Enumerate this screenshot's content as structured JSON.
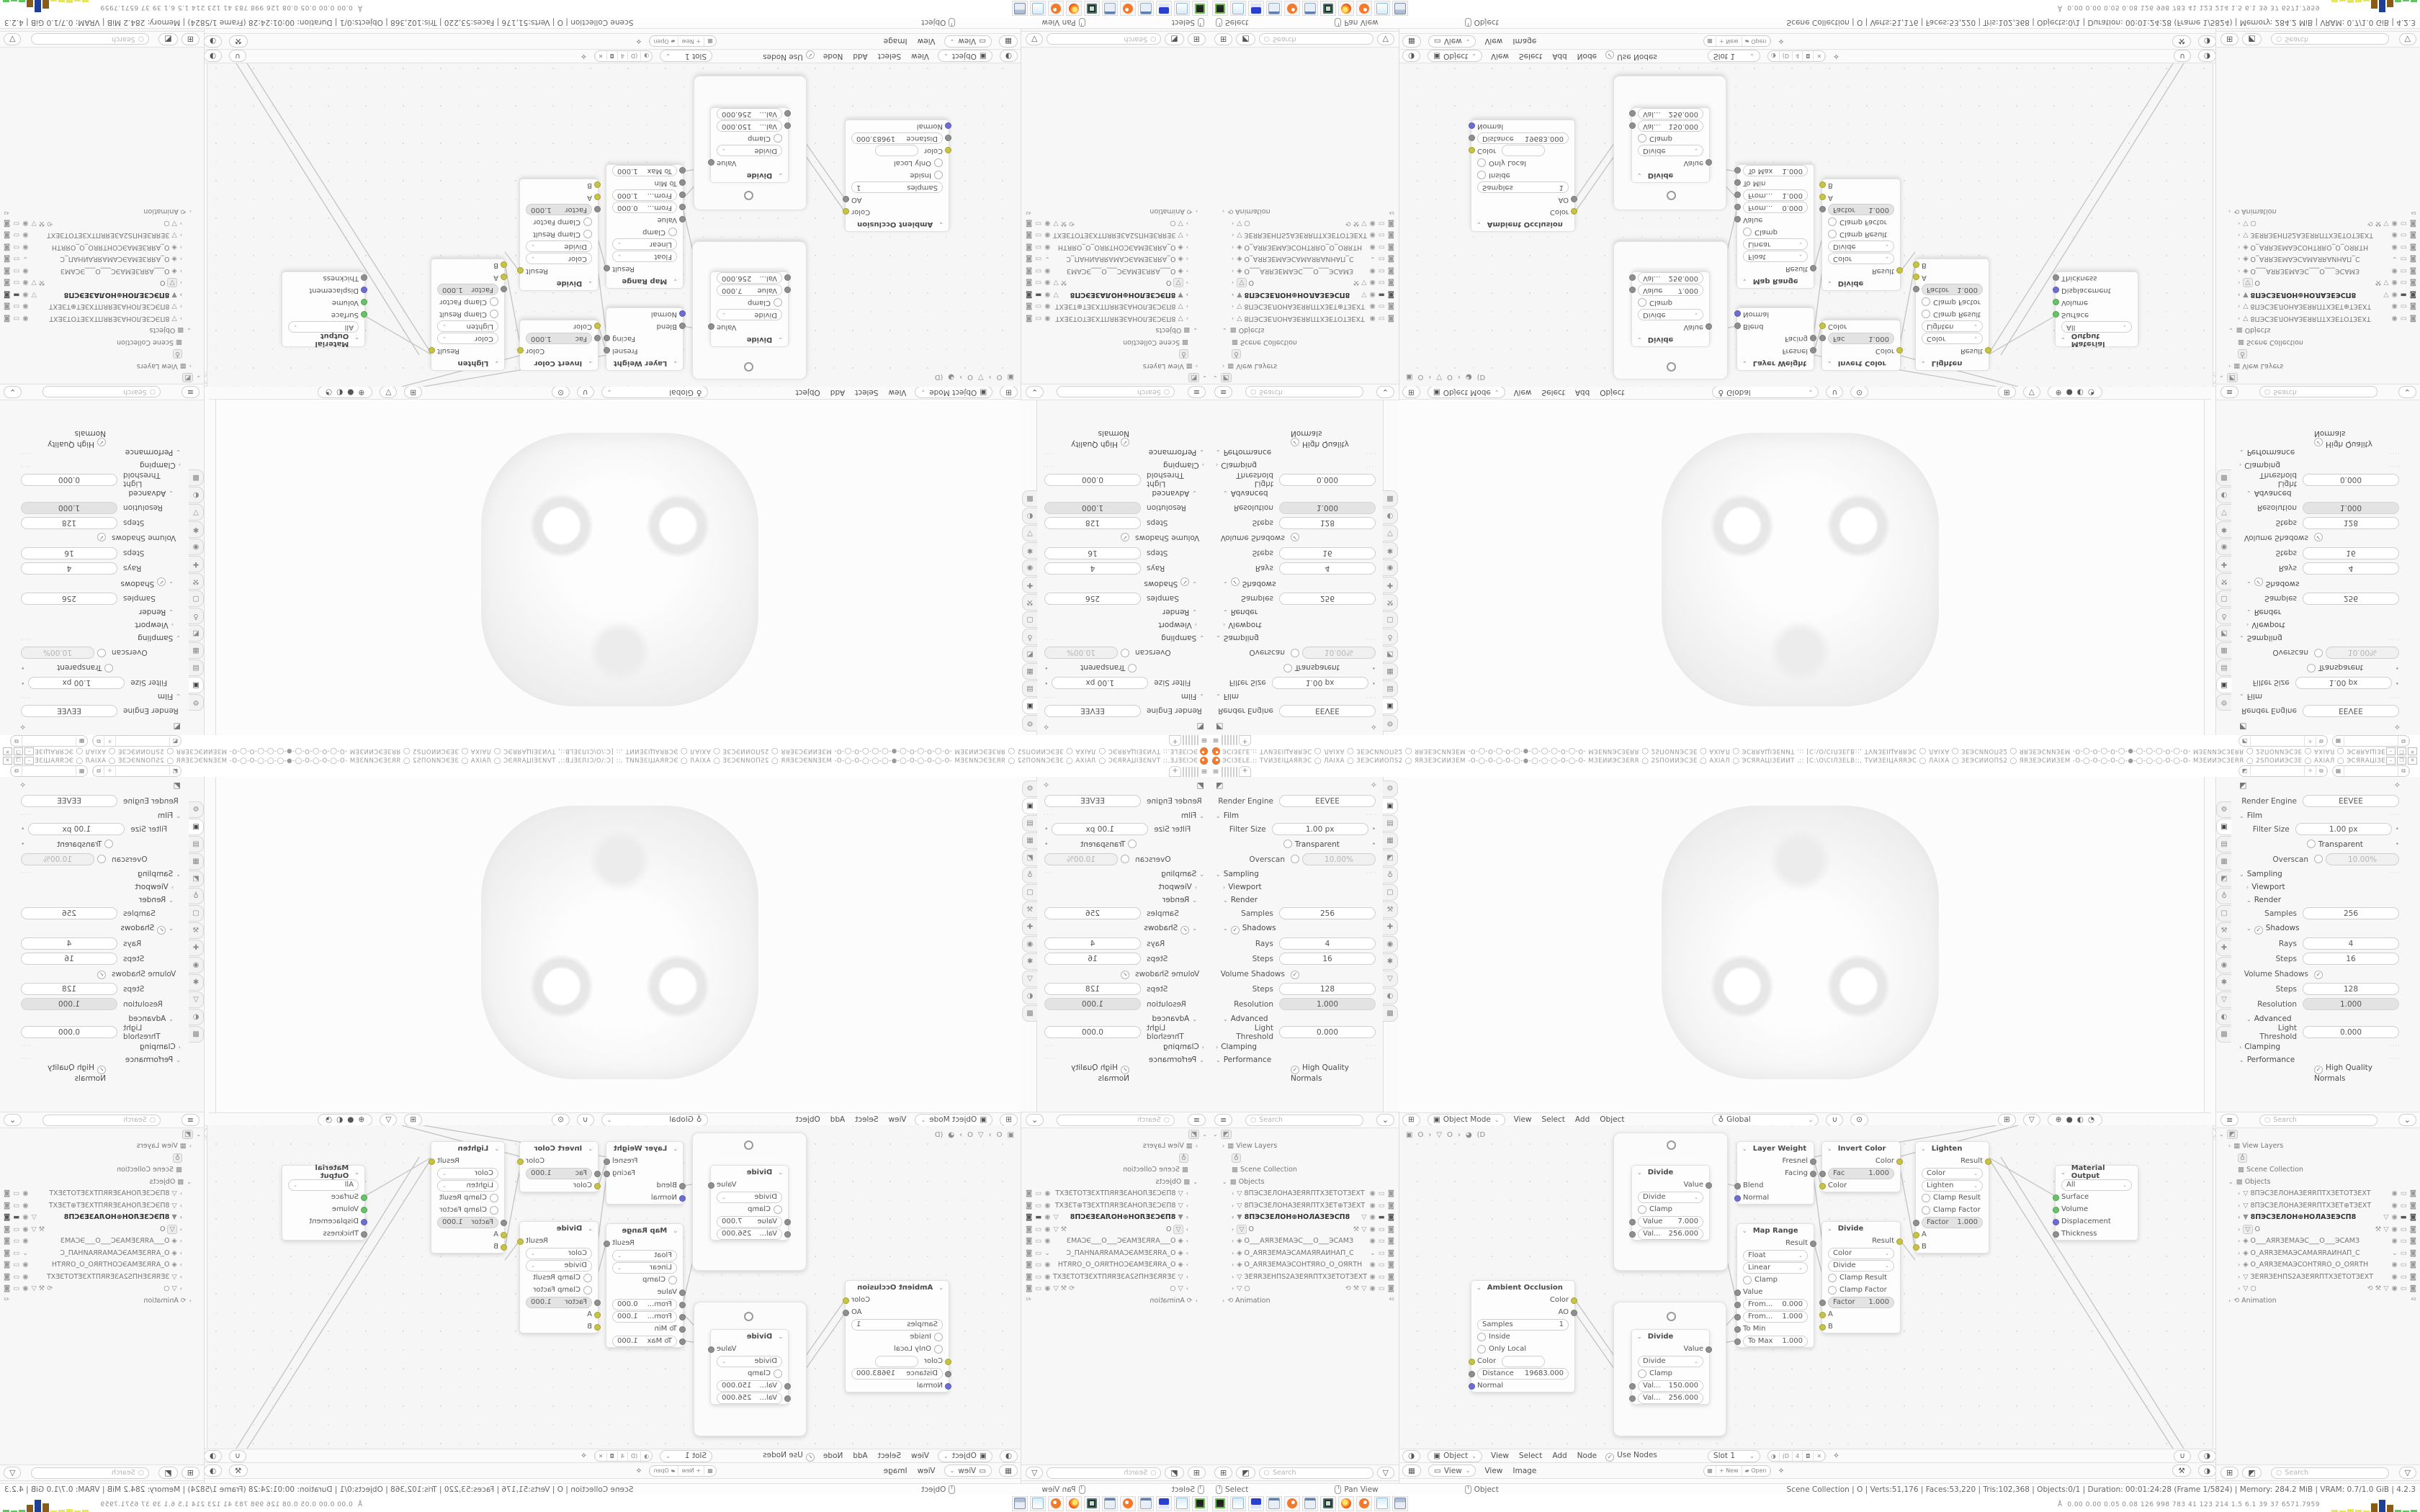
{
  "ui": {
    "search_icon": "○",
    "funnel_icon": "▽",
    "pin_icon": "✧",
    "chev": "⌄",
    "arrow": "›",
    "check": "✓",
    "plus": "+",
    "hamburger": "≡",
    "prop_icon": "◩"
  },
  "title_bar": {
    "title_text": "ЭCIЗЕLЕ.:: ТVИЗЕІЦАЯRЭС ◯ ЛАІХА ◯ ЗЕЭСИИОПЅ2 ◯ ЯRЗЕЭСИИЗЕМ -О-◯-О-◯-О-◯-●-◯-◯-◯-О-◯-О- МЗЕИИЭСЗЕRR ◯ 2ЅПОИИЭСЗЕ ◯ АХІАЛ ◯ ЭСЯRАЦІЗЕИИТ .:: [C:\\О\\СІЛЗЕLВ::, ТVИЗЕІЦАЯRЭС ◯ ЛАІХА ◯ ЗЕЭСИИОПЅ2 ◯ ЯRЗЕЭСИИЗЕМ -О-◯-О-◯-О-◯-●-◯-◯-◯-О-◯-О- МЗЕИИЭСЗЕRR ◯ 2ЅПОИИЭСЗЕ ◯ АХІАЛ ◯ ЭСЯRАЦІЗЕИИТ,:;",
    "minimize": "–",
    "maximize": "❐",
    "close": "✕"
  },
  "tab_row": {
    "tab_widths": [
      14,
      14,
      27,
      26,
      36,
      58
    ],
    "active_index": 2
  },
  "properties": {
    "render_engine_label": "Render Engine",
    "render_engine_value": "EEVEE",
    "film": "Film",
    "filter_size": "Filter Size",
    "filter_size_value": "1.00 px",
    "transparent": "Transparent",
    "overscan": "Overscan",
    "overscan_value": "10.00%",
    "sampling": "Sampling",
    "viewport": "Viewport",
    "render": "Render",
    "samples": "Samples",
    "samples_value": "256",
    "shadows": "Shadows",
    "rays": "Rays",
    "rays_value": "4",
    "steps": "Steps",
    "steps_value": "16",
    "volume_shadows": "Volume Shadows",
    "vs_steps_label": "Steps",
    "vs_steps_value": "128",
    "resolution": "Resolution",
    "resolution_value": "1.000",
    "advanced": "Advanced",
    "light_threshold": "Light Threshold",
    "light_threshold_value": "0.000",
    "clamping": "Clamping",
    "performance": "Performance",
    "hq_normals": "High Quality Normals",
    "tab_icons": [
      "⚙",
      "▣",
      "▤",
      "▦",
      "◩",
      "♁",
      "▢",
      "⚒",
      "✚",
      "◉",
      "✱",
      "▽",
      "◐",
      "▩"
    ],
    "active_tab": 1
  },
  "outliner": {
    "search_placeholder": "Search",
    "rows": [
      {
        "ind": 0,
        "chev": "⌄",
        "icon": "◩",
        "boxed": true,
        "name": "",
        "trail": "none"
      },
      {
        "ind": 1,
        "chev": "›",
        "icon": "▦",
        "name": "View Layers",
        "icon2": "▦",
        "trail": "none"
      },
      {
        "ind": 2,
        "chev": "",
        "icon": "♁",
        "boxed": true,
        "name": "",
        "trail": "none"
      },
      {
        "ind": 2,
        "chev": "",
        "icon": "▩",
        "name": "Scene Collection",
        "trail": "none"
      },
      {
        "ind": 1,
        "chev": "⌄",
        "icon": "▩",
        "name": "Objects",
        "trail": "none"
      },
      {
        "ind": 2,
        "chev": "›",
        "icon": "▽",
        "name": "8ПЭСЗЕЛОНАЗЕЯRПТХЗЕТОТЗЕХТ",
        "trail": "std"
      },
      {
        "ind": 2,
        "chev": "›",
        "icon": "▽",
        "name": "8ПЭСЗЕЛОНАЗЕЯRПТХЗЕТ⊕ТЗЕХТ",
        "trail": "std"
      },
      {
        "ind": 2,
        "chev": "›",
        "icon": "▼",
        "name": "8ПЭСЗЕЛОН⊕НОЛАЗЕЭСП8",
        "sel": true,
        "mid": "▽",
        "trail": "filled"
      },
      {
        "ind": 2,
        "chev": "›",
        "icon": "▽",
        "boxed": true,
        "name": "O",
        "mid": "⚒ ▽",
        "trail": "std"
      },
      {
        "ind": 2,
        "chev": "›",
        "icon": "◈",
        "name": "O___АЯRЗЕМАЭС___O___ЭСАМЗ",
        "trail": "std"
      },
      {
        "ind": 2,
        "chev": "›",
        "icon": "◈",
        "name": "O_АЯRЗЕМАЭСАМАЯRАИНАП_С",
        "trail": "chev"
      },
      {
        "ind": 2,
        "chev": "›",
        "icon": "◈",
        "name": "O_АЯRЗЕМАЭСОНТЯRО_О_ОЯRТН",
        "trail": "std"
      },
      {
        "ind": 2,
        "chev": "›",
        "icon": "▽",
        "name": "ЗЕЯRЗЕНПЅ2АЗЕЯRПТХЗЕТОТЗЕХТ",
        "trail": "std"
      },
      {
        "ind": 2,
        "chev": "›",
        "icon": "▽",
        "name": "○",
        "mid": "⟲ ⚒ ▽",
        "trail": "std"
      },
      {
        "ind": 1,
        "chev": "›",
        "icon": "⟲",
        "name": "Animation",
        "badge": "⁴²",
        "trail": "none"
      }
    ],
    "eye": "◉",
    "screen": "▭",
    "camera": "◙"
  },
  "viewport_header": {
    "editor_icon": "⊞",
    "mode_icon": "▣",
    "mode": "Object Mode",
    "menus": [
      "View",
      "Select",
      "Add",
      "Object"
    ],
    "orientation_icon": "♁",
    "orientation": "Global",
    "snap_icon": "∪",
    "prop_edit_icon": "⊙",
    "shading": [
      "⊕",
      "●",
      "◐",
      "◔"
    ]
  },
  "node_editor": {
    "menus": [
      "View",
      "Select",
      "Add",
      "Node"
    ],
    "breadcrumb": {
      "i1": "▣",
      "t1": "O",
      "sep": "›",
      "i2": "▽",
      "t2": "O",
      "i3": "◕",
      "t3": "(D"
    },
    "header": {
      "slot_icon": "▢",
      "shield": "◘",
      "copy": "⧉",
      "x": "✕"
    },
    "bottom": {
      "editor_icon": "◑",
      "context_icon": "▣",
      "context": "Object",
      "use_nodes": "Use Nodes",
      "slot": "Slot 1",
      "mat_icon": "◑",
      "mat_name": "(D",
      "users": "4",
      "shield": "◘",
      "x": "✕"
    },
    "nodes": {
      "ao": {
        "title": "Ambient Occlusion",
        "out1": "Color",
        "out2": "AO",
        "samples_l": "Samples",
        "samples_v": "1",
        "inside": "Inside",
        "only_local": "Only Local",
        "color_in": "Color",
        "dist_l": "Distance",
        "dist_v": "19683.000",
        "normal": "Normal"
      },
      "div1": {
        "title": "Divide",
        "out": "Value",
        "op": "Divide",
        "clamp": "Clamp",
        "v1l": "Value",
        "v1": "7.000",
        "v2l": "Val...",
        "v2": "256.000"
      },
      "div2": {
        "title": "Divide",
        "out": "Value",
        "op": "Divide",
        "clamp": "Clamp",
        "v1l": "Val...",
        "v1": "150.000",
        "v2l": "Val...",
        "v2": "256.000"
      },
      "lw": {
        "title": "Layer Weight",
        "fresnel": "Fresnel",
        "facing": "Facing",
        "blend": "Blend",
        "normal": "Normal"
      },
      "mr": {
        "title": "Map Range",
        "result": "Result",
        "type": "Float",
        "interp": "Linear",
        "clamp": "Clamp",
        "value": "Value",
        "fm_l": "From...",
        "fm_v": "0.000",
        "fx_l": "From...",
        "fx_v": "1.000",
        "tomin": "To Min",
        "tomax_l": "To Max",
        "tomax_v": "1.000"
      },
      "ic": {
        "title": "Invert Color",
        "out": "Color",
        "fac_l": "Fac",
        "fac_v": "1.000",
        "cin": "Color"
      },
      "dc": {
        "title": "Divide",
        "out": "Result",
        "t1": "Color",
        "t2": "Divide",
        "c1": "Clamp Result",
        "c2": "Clamp Factor",
        "fac_l": "Factor",
        "fac_v": "1.000",
        "a": "A",
        "b": "B"
      },
      "li": {
        "title": "Lighten",
        "out": "Result",
        "t1": "Color",
        "t2": "Lighten",
        "c1": "Clamp Result",
        "c2": "Clamp Factor",
        "fac_l": "Factor",
        "fac_v": "1.000",
        "a": "A",
        "b": "B"
      },
      "mo": {
        "title": "Material Output",
        "target": "All",
        "surface": "Surface",
        "volume": "Volume",
        "displacement": "Displacement",
        "thickness": "Thickness"
      }
    },
    "links": [
      [
        430,
        77,
        469,
        84
      ],
      [
        430,
        77,
        469,
        244
      ],
      [
        243,
        240,
        323,
        354
      ],
      [
        243,
        258,
        323,
        372
      ],
      [
        430,
        305,
        469,
        299
      ],
      [
        430,
        305,
        469,
        262
      ],
      [
        575,
        44,
        587,
        84
      ],
      [
        575,
        64,
        604,
        282
      ],
      [
        693,
        44,
        717,
        170
      ],
      [
        695,
        158,
        717,
        187
      ],
      [
        575,
        158,
        604,
        265
      ],
      [
        818,
        44,
        911,
        98
      ],
      [
        693,
        44,
        860,
        0
      ],
      [
        575,
        44,
        830,
        0
      ],
      [
        818,
        44,
        1075,
        449
      ],
      [
        836,
        44,
        1090,
        449
      ]
    ]
  },
  "image_editor": {
    "editor_icon": "▦",
    "view_icon": "▭",
    "view": "View",
    "menus": [
      "View",
      "Image"
    ],
    "new_label": "New",
    "open_label": "Open",
    "folder_icon": "▰"
  },
  "status_bar": {
    "hints": [
      {
        "label": "Select"
      },
      {
        "label": "Pan View"
      },
      {
        "label": "Object"
      }
    ],
    "stats": "Scene Collection | O | Verts:51,176 | Faces:53,220 | Tris:102,368 | Objects:0/1 | Duration: 00:01:24:28 (Frame 1/5824) | Memory: 284.2 MiB | VRAM: 0.7/1.0 GiB | 4.2.3"
  },
  "taskbar": {
    "icons": [
      "console-app-icon",
      "notepad-icon",
      "floppy-64-icon",
      "calculator-icon",
      "blender-icon",
      "calculator2-icon",
      "monitor-app-icon",
      "firefox-icon",
      "blender2-icon",
      "notepad2-icon",
      "fax-printer-icon"
    ],
    "histogram_prefix": "Å",
    "histogram_values": "0.00 0.00 0.05 0.08  126  998  783  41  123 214  1.5  6.1  39  37  6571.7959",
    "histogram_bars": [
      {
        "h": 3,
        "c": "#e6e65a"
      },
      {
        "h": 2,
        "c": "#e6e65a"
      },
      {
        "h": 4,
        "c": "#e6e65a"
      },
      {
        "h": 3,
        "c": "#e6e65a"
      },
      {
        "h": 2,
        "c": "#e6e65a"
      },
      {
        "h": 12,
        "c": "#8a5a18"
      },
      {
        "h": 17,
        "c": "#1f3f96"
      },
      {
        "h": 10,
        "c": "#8a5a18"
      },
      {
        "h": 3,
        "c": "#5cc85c"
      },
      {
        "h": 2,
        "c": "#5cc85c"
      },
      {
        "h": 3,
        "c": "#5cc85c"
      }
    ]
  }
}
